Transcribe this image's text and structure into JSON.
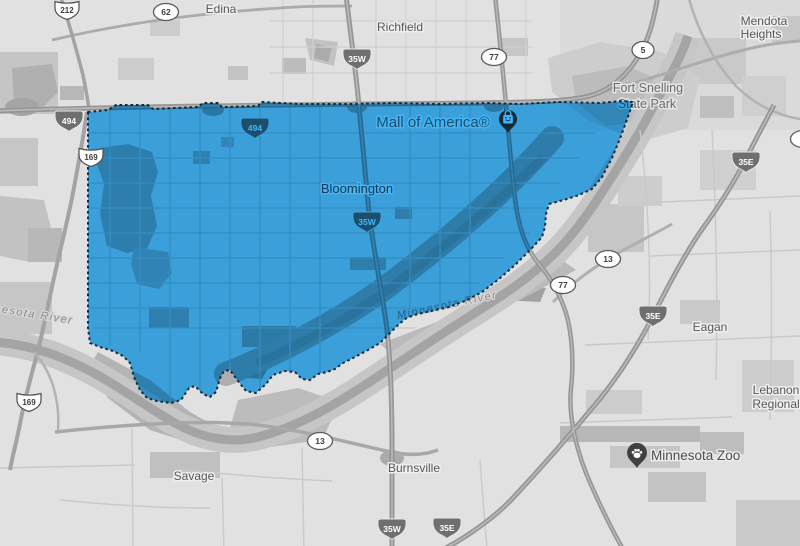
{
  "colors": {
    "region_fill_observed": "#3A9FDA",
    "region_overlay": "#42B5F8",
    "region_border": "#14293A",
    "map_background": "#E1E1E1"
  },
  "places": {
    "edina": "Edina",
    "richfield": "Richfield",
    "mendota_heights": {
      "line1": "Mendota",
      "line2": "Heights"
    },
    "fort_snelling": {
      "line1": "Fort Snelling",
      "line2": "State Park"
    },
    "mall_of_america": "Mall of America®",
    "bloomington": "Bloomington",
    "eagan": "Eagan",
    "savage": "Savage",
    "burnsville": "Burnsville",
    "minnesota_zoo": "Minnesota Zoo",
    "lebanon_regional": {
      "line1": "Lebanon",
      "line2": "Regional"
    },
    "minnesota_river_west": "Minnesota River",
    "minnesota_river_east": "Minnesota River"
  },
  "route_shields": {
    "us_212": "212",
    "mn_62": "62",
    "i_494_west": "494",
    "i_494_east": "494",
    "i_35w_north": "35W",
    "mn_77_north": "77",
    "mn_5": "5",
    "us_169_mid": "169",
    "us_169_south": "169",
    "i_35w_mid": "35W",
    "i_35e_northeast": "35E",
    "mn_13_east": "13",
    "mn_77_south": "77",
    "i_35e_mid": "35E",
    "mn_13_south": "13",
    "i_35w_south": "35W",
    "i_35e_south": "35E"
  }
}
